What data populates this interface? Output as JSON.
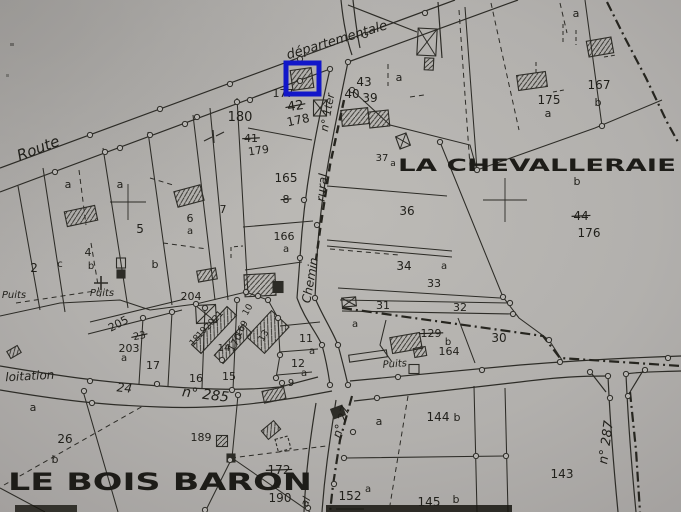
{
  "colors": {
    "paper": "#b2b0ad",
    "ink": "#2d2c27",
    "text": "#201f1a",
    "highlight": "#1217c9"
  },
  "highlight": {
    "x": 286,
    "y": 63,
    "width": 33,
    "height": 31,
    "border": 5
  },
  "place_names": [
    {
      "t": "LA CHEVALLERAIE",
      "x": 398,
      "y": 171,
      "s": 17,
      "len": 278
    },
    {
      "t": "LE BOIS BARON",
      "x": 8,
      "y": 490,
      "s": 24,
      "len": 304
    }
  ],
  "road_labels": [
    {
      "t": "Route",
      "x": 40,
      "y": 153,
      "r": -21,
      "s": 15
    },
    {
      "t": "départementale",
      "x": 338,
      "y": 44,
      "r": -17,
      "s": 13
    },
    {
      "t": "n° 1ter",
      "x": 331,
      "y": 113,
      "r": -80,
      "s": 11
    },
    {
      "t": "rural",
      "x": 326,
      "y": 188,
      "r": -84,
      "s": 12
    },
    {
      "t": "Chemin",
      "x": 314,
      "y": 281,
      "r": -80,
      "s": 12
    },
    {
      "t": "n° 27",
      "x": 345,
      "y": 423,
      "r": -73,
      "s": 12
    },
    {
      "t": "al",
      "x": 309,
      "y": 503,
      "r": -70,
      "s": 11
    },
    {
      "t": "loitation",
      "x": 30,
      "y": 380,
      "r": -3,
      "s": 12
    },
    {
      "t": "24",
      "x": 124,
      "y": 392,
      "r": 6,
      "s": 12
    },
    {
      "t": "n° 285",
      "x": 205,
      "y": 399,
      "r": 7,
      "s": 14
    },
    {
      "t": "n° 287",
      "x": 610,
      "y": 443,
      "r": -82,
      "s": 13
    },
    {
      "t": "Puits",
      "x": 14,
      "y": 298,
      "r": 0,
      "s": 10
    },
    {
      "t": "Puits",
      "x": 102,
      "y": 296,
      "r": 0,
      "s": 10
    },
    {
      "t": "Puits",
      "x": 395,
      "y": 367,
      "r": -4,
      "s": 10
    }
  ],
  "parcel_labels": [
    {
      "t": "180",
      "x": 240,
      "y": 121,
      "s": 13
    },
    {
      "t": "177",
      "x": 283,
      "y": 97,
      "s": 11
    },
    {
      "t": "42",
      "x": 296,
      "y": 110,
      "s": 13,
      "r": -8,
      "k": true
    },
    {
      "t": "178",
      "x": 299,
      "y": 124,
      "s": 12,
      "r": -12
    },
    {
      "t": "41",
      "x": 251,
      "y": 142,
      "s": 11,
      "k": true
    },
    {
      "t": "179",
      "x": 259,
      "y": 154,
      "s": 11,
      "r": -8
    },
    {
      "t": "43",
      "x": 364,
      "y": 86,
      "s": 12
    },
    {
      "t": "40",
      "x": 352,
      "y": 98,
      "s": 12
    },
    {
      "t": "39",
      "x": 370,
      "y": 102,
      "s": 12
    },
    {
      "t": "a",
      "x": 399,
      "y": 81,
      "s": 11
    },
    {
      "t": "37",
      "x": 382,
      "y": 161,
      "s": 10
    },
    {
      "t": "a",
      "x": 393,
      "y": 166,
      "s": 9
    },
    {
      "t": "165",
      "x": 286,
      "y": 182,
      "s": 12
    },
    {
      "t": "8",
      "x": 286,
      "y": 203,
      "s": 11,
      "k": true
    },
    {
      "t": "166",
      "x": 284,
      "y": 240,
      "s": 11
    },
    {
      "t": "a",
      "x": 286,
      "y": 252,
      "s": 10
    },
    {
      "t": "36",
      "x": 407,
      "y": 215,
      "s": 12
    },
    {
      "t": "34",
      "x": 404,
      "y": 270,
      "s": 12
    },
    {
      "t": "a",
      "x": 444,
      "y": 269,
      "s": 10
    },
    {
      "t": "33",
      "x": 434,
      "y": 287,
      "s": 11
    },
    {
      "t": "31",
      "x": 383,
      "y": 309,
      "s": 11
    },
    {
      "t": "32",
      "x": 460,
      "y": 311,
      "s": 11
    },
    {
      "t": "30",
      "x": 499,
      "y": 342,
      "s": 12
    },
    {
      "t": "129",
      "x": 431,
      "y": 337,
      "s": 11,
      "k": true
    },
    {
      "t": "b",
      "x": 448,
      "y": 345,
      "s": 10
    },
    {
      "t": "164",
      "x": 449,
      "y": 355,
      "s": 11
    },
    {
      "t": "a",
      "x": 355,
      "y": 327,
      "s": 10
    },
    {
      "t": "175",
      "x": 549,
      "y": 104,
      "s": 12
    },
    {
      "t": "a",
      "x": 548,
      "y": 117,
      "s": 11
    },
    {
      "t": "167",
      "x": 599,
      "y": 89,
      "s": 12
    },
    {
      "t": "b",
      "x": 598,
      "y": 106,
      "s": 11
    },
    {
      "t": "a",
      "x": 576,
      "y": 17,
      "s": 11
    },
    {
      "t": "b",
      "x": 577,
      "y": 185,
      "s": 11
    },
    {
      "t": "44",
      "x": 581,
      "y": 220,
      "s": 12,
      "k": true
    },
    {
      "t": "176",
      "x": 589,
      "y": 237,
      "s": 12
    },
    {
      "t": "a",
      "x": 68,
      "y": 188,
      "s": 11
    },
    {
      "t": "a",
      "x": 120,
      "y": 188,
      "s": 11
    },
    {
      "t": "2",
      "x": 34,
      "y": 272,
      "s": 12
    },
    {
      "t": "c",
      "x": 60,
      "y": 267,
      "s": 10
    },
    {
      "t": "4",
      "x": 88,
      "y": 256,
      "s": 11
    },
    {
      "t": "b",
      "x": 91,
      "y": 269,
      "s": 10
    },
    {
      "t": "5",
      "x": 140,
      "y": 233,
      "s": 12
    },
    {
      "t": "6",
      "x": 190,
      "y": 222,
      "s": 11
    },
    {
      "t": "a",
      "x": 190,
      "y": 234,
      "s": 10
    },
    {
      "t": "7",
      "x": 223,
      "y": 213,
      "s": 11
    },
    {
      "t": "b",
      "x": 155,
      "y": 268,
      "s": 11
    },
    {
      "t": "204",
      "x": 191,
      "y": 300,
      "s": 11
    },
    {
      "t": "205",
      "x": 120,
      "y": 327,
      "s": 11,
      "r": -28
    },
    {
      "t": "23",
      "x": 140,
      "y": 339,
      "s": 10,
      "r": -10,
      "k": true
    },
    {
      "t": "203",
      "x": 129,
      "y": 352,
      "s": 11
    },
    {
      "t": "a",
      "x": 124,
      "y": 361,
      "s": 10
    },
    {
      "t": "17",
      "x": 153,
      "y": 369,
      "s": 11
    },
    {
      "t": "16",
      "x": 196,
      "y": 382,
      "s": 11
    },
    {
      "t": "15",
      "x": 229,
      "y": 380,
      "s": 11
    },
    {
      "t": "14",
      "x": 224,
      "y": 351,
      "s": 10
    },
    {
      "t": "170",
      "x": 238,
      "y": 344,
      "s": 10,
      "r": -62
    },
    {
      "t": "169",
      "x": 244,
      "y": 330,
      "s": 9,
      "r": -62
    },
    {
      "t": "18",
      "x": 197,
      "y": 342,
      "s": 9,
      "r": -50
    },
    {
      "t": "19",
      "x": 204,
      "y": 334,
      "s": 9,
      "r": -50
    },
    {
      "t": "20",
      "x": 212,
      "y": 326,
      "s": 9,
      "r": -50
    },
    {
      "t": "21",
      "x": 220,
      "y": 318,
      "s": 9,
      "r": -50
    },
    {
      "t": "10",
      "x": 250,
      "y": 311,
      "s": 9,
      "r": -60
    },
    {
      "t": "13",
      "x": 266,
      "y": 337,
      "s": 9,
      "r": -60
    },
    {
      "t": "11",
      "x": 306,
      "y": 342,
      "s": 11
    },
    {
      "t": "a",
      "x": 312,
      "y": 354,
      "s": 10
    },
    {
      "t": "12",
      "x": 298,
      "y": 367,
      "s": 11
    },
    {
      "t": "a",
      "x": 304,
      "y": 376,
      "s": 10
    },
    {
      "t": "9",
      "x": 291,
      "y": 386,
      "s": 10
    },
    {
      "t": "a",
      "x": 33,
      "y": 411,
      "s": 11
    },
    {
      "t": "26",
      "x": 65,
      "y": 443,
      "s": 12
    },
    {
      "t": "b",
      "x": 55,
      "y": 463,
      "s": 11
    },
    {
      "t": "189",
      "x": 201,
      "y": 441,
      "s": 11
    },
    {
      "t": "172",
      "x": 279,
      "y": 474,
      "s": 12,
      "k": true
    },
    {
      "t": "a",
      "x": 277,
      "y": 488,
      "s": 11
    },
    {
      "t": "190",
      "x": 280,
      "y": 502,
      "s": 12
    },
    {
      "t": "152",
      "x": 350,
      "y": 500,
      "s": 12
    },
    {
      "t": "a",
      "x": 368,
      "y": 492,
      "s": 10
    },
    {
      "t": "144",
      "x": 438,
      "y": 421,
      "s": 12
    },
    {
      "t": "b",
      "x": 457,
      "y": 421,
      "s": 11
    },
    {
      "t": "a",
      "x": 379,
      "y": 425,
      "s": 11
    },
    {
      "t": "145",
      "x": 429,
      "y": 506,
      "s": 12
    },
    {
      "t": "b",
      "x": 456,
      "y": 503,
      "s": 11
    },
    {
      "t": "143",
      "x": 562,
      "y": 478,
      "s": 12
    }
  ]
}
